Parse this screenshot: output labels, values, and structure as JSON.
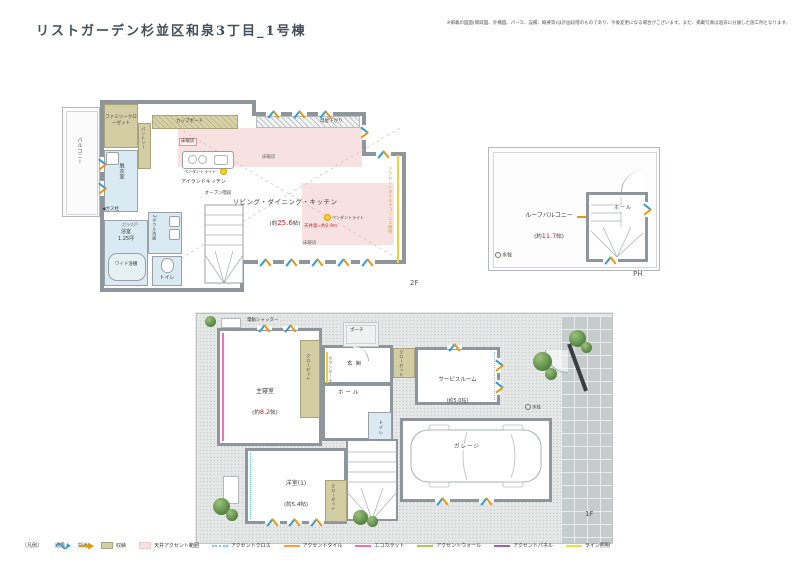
{
  "header": {
    "title": "リストガーデン杉並区和泉3丁目_1号棟",
    "disclaimer": "※掲載の図面(間取図、外構図、パース、設備、概要等)は計画段階のものであり、今後変更になる場合がございます。また、掲載写真は過去に分譲した施工例となります。"
  },
  "floor_2f": {
    "floor_label": "2F",
    "balcony": "バルコニー",
    "family_closet": "ファミリークローゼット",
    "cupboard": "カップボード",
    "pantry": "パントリー",
    "dressing_room": "脱衣室",
    "gas_outlet": "◀ガス栓",
    "glass_door": "ガラス戸",
    "bath": "浴室",
    "bath_size": "1.25坪",
    "wide_tub": "ワイド浴槽",
    "toilet": "トイレ",
    "two_bowl_vanity": "2ボウル洗面",
    "open_stairs": "オープン階段",
    "island_kitchen": "アイランドキッチン",
    "pendant_light": "ペンダントライト",
    "floor_heating": "床暖房",
    "ldk": {
      "name": "リビング・ダイニング・キッチン",
      "size_pre": "(約",
      "size_val": "25.6",
      "size_suf": "帖)"
    },
    "ceiling_height": "天井高=約2.9m",
    "moya_sagari": "母屋下がり",
    "accent_tile_note": "アクセントタイル+コーニス照明"
  },
  "floor_ph": {
    "floor_label": "PH",
    "roof_balcony": {
      "name": "ルーフバルコニー",
      "size_pre": "(約",
      "size_val": "11.7",
      "size_suf": "帖)"
    },
    "hall": "ホール",
    "water_tap": "水栓"
  },
  "floor_1f": {
    "floor_label": "1F",
    "electric_shutter": "電動シャッター",
    "porch": "ポーチ",
    "master_bedroom": {
      "name": "主寝室",
      "size_pre": "(約",
      "size_val": "8.2",
      "size_suf": "帖)"
    },
    "closet": "クローゼット",
    "counter_storage": "カウンター+玄関収納",
    "entrance": "玄関",
    "hall": "ホール",
    "service_room": {
      "name": "サービスルーム",
      "size_pre": "(約",
      "size_val": "5.0",
      "size_suf": "帖)"
    },
    "toilet": "トイレ",
    "western_room1": {
      "name": "洋室(1)",
      "size_pre": "(約",
      "size_val": "5.4",
      "size_suf": "帖)"
    },
    "garage": "ガレージ",
    "water_tap": "水栓"
  },
  "legend": {
    "title": "〔凡例〕",
    "items": [
      {
        "label": "通風",
        "color": "#2e9bd6"
      },
      {
        "label": "採光",
        "color": "#e8950f"
      },
      {
        "label": "収納",
        "color": "#d3cda4"
      },
      {
        "label": "天井アクセント範囲",
        "color": "#f7e1e1"
      },
      {
        "label": "アクセントクロス",
        "color": "#6fcbe0"
      },
      {
        "label": "アクセントタイル",
        "color": "#f0a53c"
      },
      {
        "label": "エコカラット",
        "color": "#ef6fb0"
      },
      {
        "label": "アクセントウォール",
        "color": "#a6cc55"
      },
      {
        "label": "アクセントパネル",
        "color": "#a65ab0"
      },
      {
        "label": "ライン照明",
        "color": "#ede23a"
      }
    ]
  },
  "colors": {
    "wall": "#8f969b",
    "size_accent_red": "#c22222",
    "water_area_blue": "#d9eaf2",
    "storage_beige": "#d3cda4",
    "ceiling_accent_pink": "#f7e1e1",
    "cornice_note_yellow": "#d9a300"
  }
}
